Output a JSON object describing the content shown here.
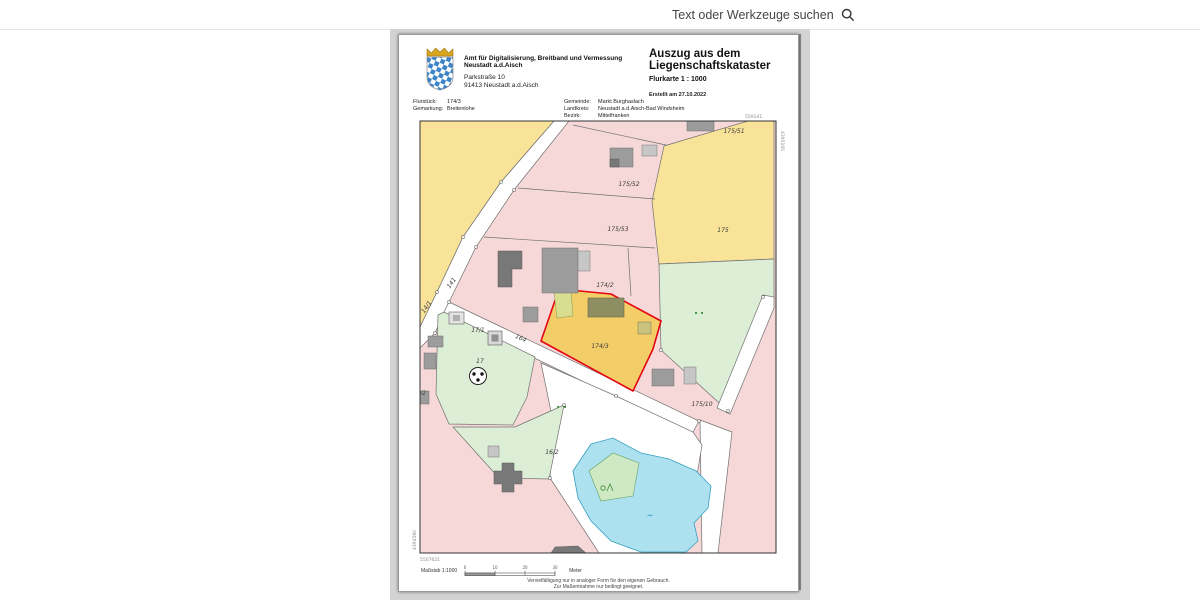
{
  "toolbar": {
    "search_label": "Text oder Werkzeuge suchen"
  },
  "document": {
    "header": {
      "org_line1": "Amt für Digitalisierung, Breitband und Vermessung",
      "org_line2": "Neustadt a.d.Aisch",
      "address_line1": "Parkstraße 10",
      "address_line2": "91413 Neustadt a.d.Aisch",
      "title_line1": "Auszug aus dem",
      "title_line2": "Liegenschaftskataster",
      "subtitle": "Flurkarte 1 : 1000",
      "created": "Erstellt am 27.10.2022"
    },
    "meta": {
      "flurstueck_label": "Flurstück:",
      "flurstueck_value": "174/3",
      "gemarkung_label": "Gemarkung:",
      "gemarkung_value": "Breitenlohe",
      "gemeinde_label": "Gemeinde:",
      "gemeinde_value": "Markt Burghaslach",
      "landkreis_label": "Landkreis:",
      "landkreis_value": "Neustadt a.d.Aisch-Bad Windsheim",
      "bezirk_label": "Bezirk:",
      "bezirk_value": "Mittelfranken"
    },
    "map": {
      "highlighted_parcel": "174/3",
      "colors": {
        "parcel_pink": "#f7d8d8",
        "parcel_yellow": "#f8e399",
        "parcel_highlight_fill": "#f2cd68",
        "parcel_green": "#ddeed6",
        "water": "#ade1f0",
        "highlight_outline": "#e30613",
        "building_gray": "#9c9c9c"
      },
      "parcel_labels": [
        {
          "text": "175/51",
          "x": 733,
          "y": 132
        },
        {
          "text": "175/52",
          "x": 628,
          "y": 185
        },
        {
          "text": "175/53",
          "x": 617,
          "y": 230
        },
        {
          "text": "175",
          "x": 722,
          "y": 231
        },
        {
          "text": "174/2",
          "x": 604,
          "y": 286
        },
        {
          "text": "174/3",
          "x": 599,
          "y": 347
        },
        {
          "text": "175/10",
          "x": 701,
          "y": 405
        },
        {
          "text": "17/1",
          "x": 477,
          "y": 331
        },
        {
          "text": "17",
          "x": 479,
          "y": 362
        },
        {
          "text": "16/2",
          "x": 551,
          "y": 453
        },
        {
          "text": "/2",
          "x": 422,
          "y": 394
        },
        {
          "text": "141",
          "x": 452,
          "y": 283,
          "rot": -55
        },
        {
          "text": "14/1",
          "x": 427,
          "y": 307,
          "rot": -55
        },
        {
          "text": "164",
          "x": 519,
          "y": 339,
          "rot": 24
        },
        {
          "text": "~",
          "x": 649,
          "y": 517,
          "cls": "water"
        }
      ],
      "margin_labels": [
        {
          "text": "559141",
          "x": 744,
          "y": 117
        },
        {
          "text": "4395105",
          "x": 780,
          "y": 130,
          "rot": 90
        },
        {
          "text": "5507621",
          "x": 419,
          "y": 560
        },
        {
          "text": "4394560",
          "x": 415,
          "y": 549,
          "rot": -90
        }
      ]
    },
    "scalebar": {
      "label": "Maßstab 1:1000",
      "unit": "Meter",
      "ticks": [
        "0",
        "10",
        "20",
        "30"
      ]
    },
    "footer_line1": "Vervielfältigung nur in analoger Form für den eigenen Gebrauch.",
    "footer_line2": "Zur Maßentnahme nur bedingt geeignet."
  }
}
